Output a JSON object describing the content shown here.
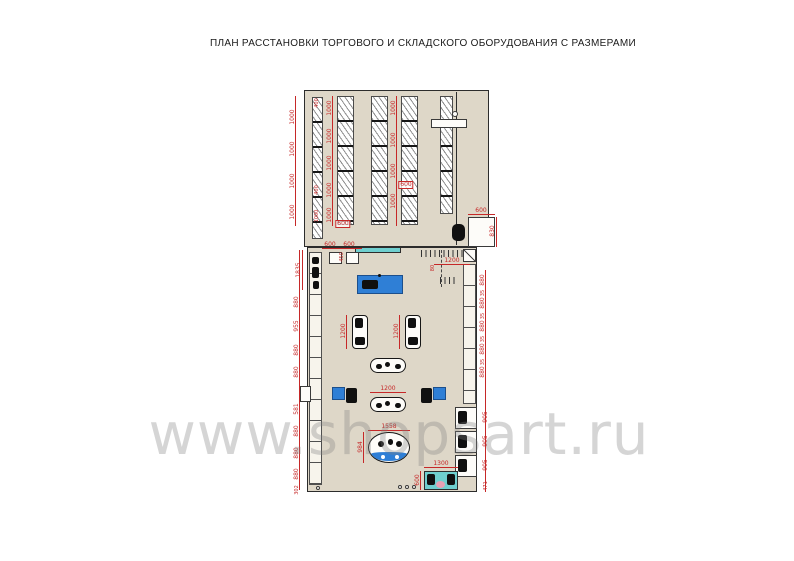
{
  "title": "ПЛАН РАССТАНОВКИ ТОРГОВОГО И СКЛАДСКОГО ОБОРУДОВАНИЯ С РАЗМЕРАМИ",
  "watermark": "www.shopsart.ru",
  "colors": {
    "dimension": "#c62828",
    "floor": "#ded7c8",
    "wall": "#2c2c2c",
    "furniture_blue": "#2f7fd6",
    "teal": "#6fcfcf",
    "pink": "#e8a0b4",
    "watermark_gray": "#c9c9c9"
  },
  "plan": {
    "dimensions": [
      {
        "x": 293,
        "y": 117,
        "r": 1,
        "t": "1000"
      },
      {
        "x": 293,
        "y": 149,
        "r": 1,
        "t": "1000"
      },
      {
        "x": 293,
        "y": 181,
        "r": 1,
        "t": "1000"
      },
      {
        "x": 293,
        "y": 212,
        "r": 1,
        "t": "1000"
      },
      {
        "x": 317,
        "y": 103,
        "r": 1,
        "t": "400",
        "s": 1
      },
      {
        "x": 317,
        "y": 190,
        "r": 1,
        "t": "400",
        "s": 1
      },
      {
        "x": 317,
        "y": 216,
        "r": 1,
        "t": "1000",
        "s": 1
      },
      {
        "x": 330,
        "y": 108,
        "r": 1,
        "t": "1000"
      },
      {
        "x": 330,
        "y": 136,
        "r": 1,
        "t": "1000"
      },
      {
        "x": 330,
        "y": 163,
        "r": 1,
        "t": "1000"
      },
      {
        "x": 330,
        "y": 190,
        "r": 1,
        "t": "1000"
      },
      {
        "x": 330,
        "y": 215,
        "r": 1,
        "t": "1000"
      },
      {
        "x": 343,
        "y": 224,
        "t": "600",
        "b": 1
      },
      {
        "x": 394,
        "y": 108,
        "r": 1,
        "t": "1000"
      },
      {
        "x": 394,
        "y": 140,
        "r": 1,
        "t": "1000"
      },
      {
        "x": 394,
        "y": 171,
        "r": 1,
        "t": "1000"
      },
      {
        "x": 394,
        "y": 201,
        "r": 1,
        "t": "1000"
      },
      {
        "x": 406,
        "y": 185,
        "t": "600",
        "b": 1
      },
      {
        "x": 481,
        "y": 211,
        "t": "600"
      },
      {
        "x": 493,
        "y": 231,
        "r": 1,
        "t": "830"
      },
      {
        "x": 330,
        "y": 245,
        "t": "600"
      },
      {
        "x": 349,
        "y": 245,
        "t": "600"
      },
      {
        "x": 342,
        "y": 257,
        "r": 1,
        "t": "450",
        "s": 1
      },
      {
        "x": 299,
        "y": 270,
        "r": 1,
        "t": "1835"
      },
      {
        "x": 452,
        "y": 261,
        "t": "1200"
      },
      {
        "x": 433,
        "y": 268,
        "r": 1,
        "t": "80",
        "s": 1
      },
      {
        "x": 297,
        "y": 302,
        "r": 1,
        "t": "880"
      },
      {
        "x": 297,
        "y": 326,
        "r": 1,
        "t": "955"
      },
      {
        "x": 297,
        "y": 350,
        "r": 1,
        "t": "880"
      },
      {
        "x": 297,
        "y": 372,
        "r": 1,
        "t": "880"
      },
      {
        "x": 297,
        "y": 409,
        "r": 1,
        "t": "581"
      },
      {
        "x": 297,
        "y": 431,
        "r": 1,
        "t": "880"
      },
      {
        "x": 297,
        "y": 453,
        "r": 1,
        "t": "880"
      },
      {
        "x": 297,
        "y": 474,
        "r": 1,
        "t": "880"
      },
      {
        "x": 297,
        "y": 490,
        "r": 1,
        "t": "302",
        "s": 1
      },
      {
        "x": 483,
        "y": 280,
        "r": 1,
        "t": "880"
      },
      {
        "x": 483,
        "y": 293,
        "r": 1,
        "t": "35",
        "s": 1
      },
      {
        "x": 483,
        "y": 303,
        "r": 1,
        "t": "880"
      },
      {
        "x": 483,
        "y": 316,
        "r": 1,
        "t": "35",
        "s": 1
      },
      {
        "x": 483,
        "y": 326,
        "r": 1,
        "t": "880"
      },
      {
        "x": 483,
        "y": 339,
        "r": 1,
        "t": "35",
        "s": 1
      },
      {
        "x": 483,
        "y": 349,
        "r": 1,
        "t": "880"
      },
      {
        "x": 483,
        "y": 362,
        "r": 1,
        "t": "35",
        "s": 1
      },
      {
        "x": 483,
        "y": 372,
        "r": 1,
        "t": "880"
      },
      {
        "x": 486,
        "y": 417,
        "r": 1,
        "t": "905"
      },
      {
        "x": 486,
        "y": 441,
        "r": 1,
        "t": "905"
      },
      {
        "x": 486,
        "y": 465,
        "r": 1,
        "t": "905"
      },
      {
        "x": 486,
        "y": 486,
        "r": 1,
        "t": "471",
        "s": 1
      },
      {
        "x": 344,
        "y": 331,
        "r": 1,
        "t": "1200"
      },
      {
        "x": 397,
        "y": 331,
        "r": 1,
        "t": "1200"
      },
      {
        "x": 388,
        "y": 389,
        "t": "1200"
      },
      {
        "x": 389,
        "y": 427,
        "t": "1558"
      },
      {
        "x": 361,
        "y": 447,
        "r": 1,
        "t": "984"
      },
      {
        "x": 441,
        "y": 464,
        "t": "1300"
      },
      {
        "x": 418,
        "y": 480,
        "r": 1,
        "t": "600"
      }
    ]
  }
}
